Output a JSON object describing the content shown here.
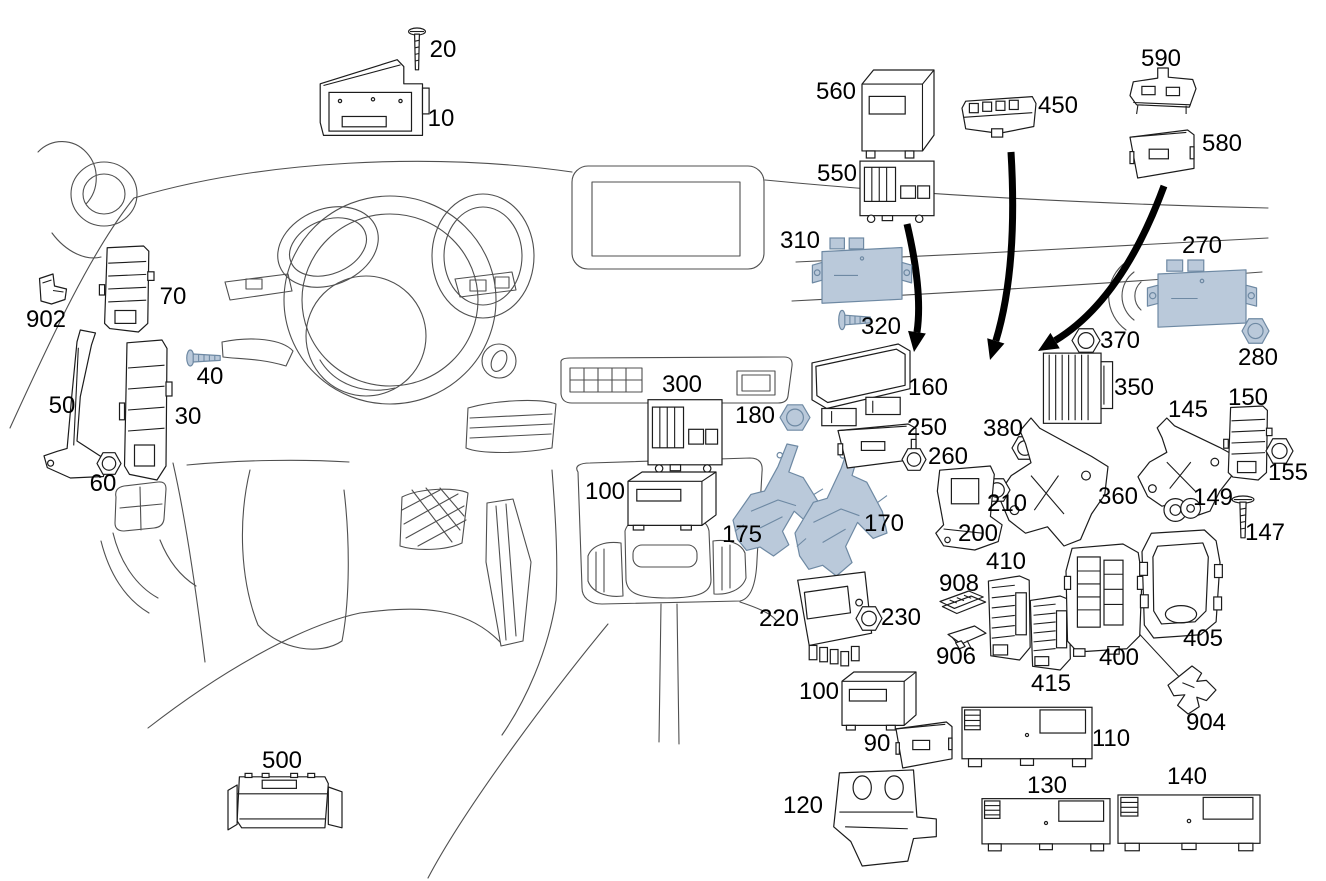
{
  "diagram": {
    "kind": "exploded-parts-diagram",
    "subject": "dashboard-control-units",
    "background": "vehicle-dashboard-line-art"
  },
  "colors": {
    "background": "#ffffff",
    "sketch_line": "#4f4f4f",
    "part_line": "#1c1c1c",
    "part_fill": "#ffffff",
    "highlight_fill": "#bac9da",
    "highlight_stroke": "#6e89a3",
    "label": "#000000",
    "arrow": "#000000"
  },
  "parts": [
    {
      "label": "20",
      "glyph": "screw-v",
      "box": [
        407,
        28,
        20,
        44
      ],
      "label_pos": [
        443,
        57
      ],
      "highlight": false
    },
    {
      "label": "10",
      "glyph": "hud",
      "box": [
        318,
        58,
        110,
        86
      ],
      "label_pos": [
        441,
        126
      ],
      "highlight": false
    },
    {
      "label": "902",
      "glyph": "clip",
      "box": [
        38,
        274,
        30,
        30
      ],
      "label_pos": [
        46,
        327
      ],
      "highlight": false
    },
    {
      "label": "70",
      "glyph": "stack",
      "box": [
        102,
        246,
        52,
        86
      ],
      "label_pos": [
        173,
        304
      ],
      "highlight": false
    },
    {
      "label": "40",
      "glyph": "screw-h",
      "box": [
        186,
        348,
        36,
        20
      ],
      "label_pos": [
        210,
        384
      ],
      "highlight": true
    },
    {
      "label": "50",
      "glyph": "bracket-tall",
      "box": [
        44,
        330,
        66,
        148
      ],
      "label_pos": [
        62,
        413
      ],
      "highlight": false
    },
    {
      "label": "30",
      "glyph": "stack",
      "box": [
        122,
        340,
        50,
        140
      ],
      "label_pos": [
        188,
        424
      ],
      "highlight": false
    },
    {
      "label": "60",
      "glyph": "nut",
      "box": [
        97,
        452,
        24,
        23
      ],
      "label_pos": [
        103,
        491
      ],
      "highlight": false
    },
    {
      "label": "300",
      "glyph": "fuse-box",
      "box": [
        648,
        396,
        74,
        74
      ],
      "label_pos": [
        682,
        392
      ],
      "highlight": false
    },
    {
      "label": "100",
      "glyph": "module",
      "box": [
        628,
        472,
        88,
        58
      ],
      "label_pos": [
        605,
        499
      ],
      "highlight": false
    },
    {
      "label": "180",
      "glyph": "nut",
      "box": [
        780,
        404,
        30,
        27
      ],
      "label_pos": [
        755,
        423
      ],
      "highlight": true
    },
    {
      "label": "175",
      "glyph": "tube-bracket",
      "box": [
        733,
        444,
        90,
        112
      ],
      "label_pos": [
        742,
        542
      ],
      "highlight": true
    },
    {
      "label": "170",
      "glyph": "tube-bracket",
      "box": [
        795,
        442,
        92,
        134
      ],
      "label_pos": [
        884,
        531
      ],
      "highlight": true
    },
    {
      "label": "560",
      "glyph": "module",
      "box": [
        862,
        70,
        72,
        88
      ],
      "label_pos": [
        836,
        99
      ],
      "highlight": false
    },
    {
      "label": "550",
      "glyph": "fuse-box",
      "box": [
        860,
        158,
        74,
        62
      ],
      "label_pos": [
        837,
        181
      ],
      "highlight": false
    },
    {
      "label": "450",
      "glyph": "rail",
      "box": [
        962,
        92,
        74,
        46
      ],
      "label_pos": [
        1058,
        113
      ],
      "highlight": false
    },
    {
      "label": "590",
      "glyph": "mount",
      "box": [
        1130,
        68,
        66,
        46
      ],
      "label_pos": [
        1161,
        66
      ],
      "highlight": false
    },
    {
      "label": "580",
      "glyph": "module-flat",
      "box": [
        1130,
        130,
        64,
        48
      ],
      "label_pos": [
        1222,
        151
      ],
      "highlight": false
    },
    {
      "label": "310",
      "glyph": "module-tabs",
      "box": [
        822,
        238,
        80,
        68
      ],
      "label_pos": [
        800,
        248
      ],
      "highlight": true
    },
    {
      "label": "320",
      "glyph": "screw-h",
      "box": [
        838,
        308,
        34,
        24
      ],
      "label_pos": [
        881,
        334
      ],
      "highlight": true
    },
    {
      "label": "270",
      "glyph": "module-tabs",
      "box": [
        1158,
        260,
        88,
        70
      ],
      "label_pos": [
        1202,
        253
      ],
      "highlight": true
    },
    {
      "label": "280",
      "glyph": "nut",
      "box": [
        1242,
        318,
        27,
        26
      ],
      "label_pos": [
        1258,
        365
      ],
      "highlight": true
    },
    {
      "label": "370",
      "glyph": "nut",
      "box": [
        1072,
        328,
        28,
        25
      ],
      "label_pos": [
        1120,
        348
      ],
      "highlight": false
    },
    {
      "label": "160",
      "glyph": "panel-module",
      "box": [
        812,
        344,
        98,
        86
      ],
      "label_pos": [
        928,
        395
      ],
      "highlight": false
    },
    {
      "label": "250",
      "glyph": "module-flat",
      "box": [
        838,
        424,
        78,
        44
      ],
      "label_pos": [
        927,
        435
      ],
      "highlight": false
    },
    {
      "label": "260",
      "glyph": "nut",
      "box": [
        902,
        448,
        24,
        23
      ],
      "label_pos": [
        948,
        464
      ],
      "highlight": false
    },
    {
      "label": "380",
      "glyph": "nut",
      "box": [
        1012,
        436,
        26,
        24
      ],
      "label_pos": [
        1003,
        436
      ],
      "highlight": false
    },
    {
      "label": "350",
      "glyph": "finned",
      "box": [
        1042,
        350,
        72,
        78
      ],
      "label_pos": [
        1134,
        395
      ],
      "highlight": false
    },
    {
      "label": "360",
      "glyph": "bracket",
      "box": [
        998,
        418,
        110,
        128
      ],
      "label_pos": [
        1118,
        504
      ],
      "highlight": false
    },
    {
      "label": "145",
      "glyph": "bracket",
      "box": [
        1138,
        418,
        96,
        98
      ],
      "label_pos": [
        1188,
        417
      ],
      "highlight": false
    },
    {
      "label": "150",
      "glyph": "stack",
      "box": [
        1226,
        406,
        46,
        74
      ],
      "label_pos": [
        1248,
        405
      ],
      "highlight": false
    },
    {
      "label": "155",
      "glyph": "nut",
      "box": [
        1266,
        438,
        27,
        26
      ],
      "label_pos": [
        1288,
        480
      ],
      "highlight": false
    },
    {
      "label": "149",
      "glyph": "grommet",
      "box": [
        1164,
        494,
        38,
        32
      ],
      "label_pos": [
        1213,
        505
      ],
      "highlight": false
    },
    {
      "label": "147",
      "glyph": "screw-v",
      "box": [
        1230,
        496,
        26,
        44
      ],
      "label_pos": [
        1265,
        540
      ],
      "highlight": false
    },
    {
      "label": "210",
      "glyph": "nut",
      "box": [
        984,
        478,
        26,
        24
      ],
      "label_pos": [
        1007,
        511
      ],
      "highlight": false
    },
    {
      "label": "200",
      "glyph": "bracket-s",
      "box": [
        928,
        466,
        78,
        84
      ],
      "label_pos": [
        978,
        541
      ],
      "highlight": false
    },
    {
      "label": "220",
      "glyph": "ecu-teeth",
      "box": [
        790,
        572,
        96,
        102
      ],
      "label_pos": [
        779,
        626
      ],
      "highlight": false
    },
    {
      "label": "230",
      "glyph": "nut",
      "box": [
        856,
        606,
        26,
        25
      ],
      "label_pos": [
        901,
        625
      ],
      "highlight": false
    },
    {
      "label": "908",
      "glyph": "fuse-set",
      "box": [
        940,
        588,
        48,
        30
      ],
      "label_pos": [
        959,
        591
      ],
      "highlight": false
    },
    {
      "label": "906",
      "glyph": "fuse",
      "box": [
        948,
        626,
        38,
        24
      ],
      "label_pos": [
        956,
        664
      ],
      "highlight": false
    },
    {
      "label": "410",
      "glyph": "fuse-box-v",
      "box": [
        986,
        576,
        48,
        84
      ],
      "label_pos": [
        1006,
        569
      ],
      "highlight": false
    },
    {
      "label": "415",
      "glyph": "fuse-box-v",
      "box": [
        1028,
        596,
        46,
        74
      ],
      "label_pos": [
        1051,
        691
      ],
      "highlight": false
    },
    {
      "label": "400",
      "glyph": "fuse-box-big",
      "box": [
        1066,
        544,
        76,
        108
      ],
      "label_pos": [
        1119,
        665
      ],
      "highlight": false
    },
    {
      "label": "405",
      "glyph": "frame",
      "box": [
        1142,
        530,
        78,
        108
      ],
      "label_pos": [
        1203,
        646
      ],
      "highlight": false
    },
    {
      "label": "904",
      "glyph": "shield",
      "box": [
        1168,
        666,
        48,
        48
      ],
      "label_pos": [
        1206,
        730
      ],
      "highlight": false
    },
    {
      "label": "100",
      "glyph": "module",
      "box": [
        842,
        672,
        74,
        58
      ],
      "label_pos": [
        819,
        699
      ],
      "highlight": false
    },
    {
      "label": "90",
      "glyph": "module-flat",
      "box": [
        896,
        722,
        56,
        46
      ],
      "label_pos": [
        877,
        751
      ],
      "highlight": false
    },
    {
      "label": "110",
      "glyph": "module-wide",
      "box": [
        962,
        702,
        130,
        66
      ],
      "label_pos": [
        1111,
        746
      ],
      "highlight": false
    },
    {
      "label": "120",
      "glyph": "bracket-m",
      "box": [
        828,
        768,
        114,
        98
      ],
      "label_pos": [
        803,
        813
      ],
      "highlight": false
    },
    {
      "label": "130",
      "glyph": "module-wide",
      "box": [
        982,
        794,
        128,
        58
      ],
      "label_pos": [
        1047,
        793
      ],
      "highlight": false
    },
    {
      "label": "140",
      "glyph": "module-wide",
      "box": [
        1118,
        790,
        142,
        62
      ],
      "label_pos": [
        1187,
        784
      ],
      "highlight": false
    },
    {
      "label": "500",
      "glyph": "tray",
      "box": [
        228,
        770,
        114,
        68
      ],
      "label_pos": [
        282,
        768
      ],
      "highlight": false
    }
  ],
  "arrows": [
    {
      "name": "flow-arrow-left",
      "tail": [
        907,
        224
      ],
      "ctrl": [
        923,
        292
      ],
      "tip": [
        914,
        352
      ]
    },
    {
      "name": "flow-arrow-middle",
      "tail": [
        1011,
        152
      ],
      "ctrl": [
        1018,
        268
      ],
      "tip": [
        990,
        360
      ]
    },
    {
      "name": "flow-arrow-right",
      "tail": [
        1164,
        186
      ],
      "ctrl": [
        1122,
        300
      ],
      "tip": [
        1038,
        351
      ]
    }
  ],
  "leader_lines": [
    {
      "from": "400",
      "to": "904",
      "x1": 1132,
      "y1": 626,
      "x2": 1184,
      "y2": 682
    }
  ]
}
